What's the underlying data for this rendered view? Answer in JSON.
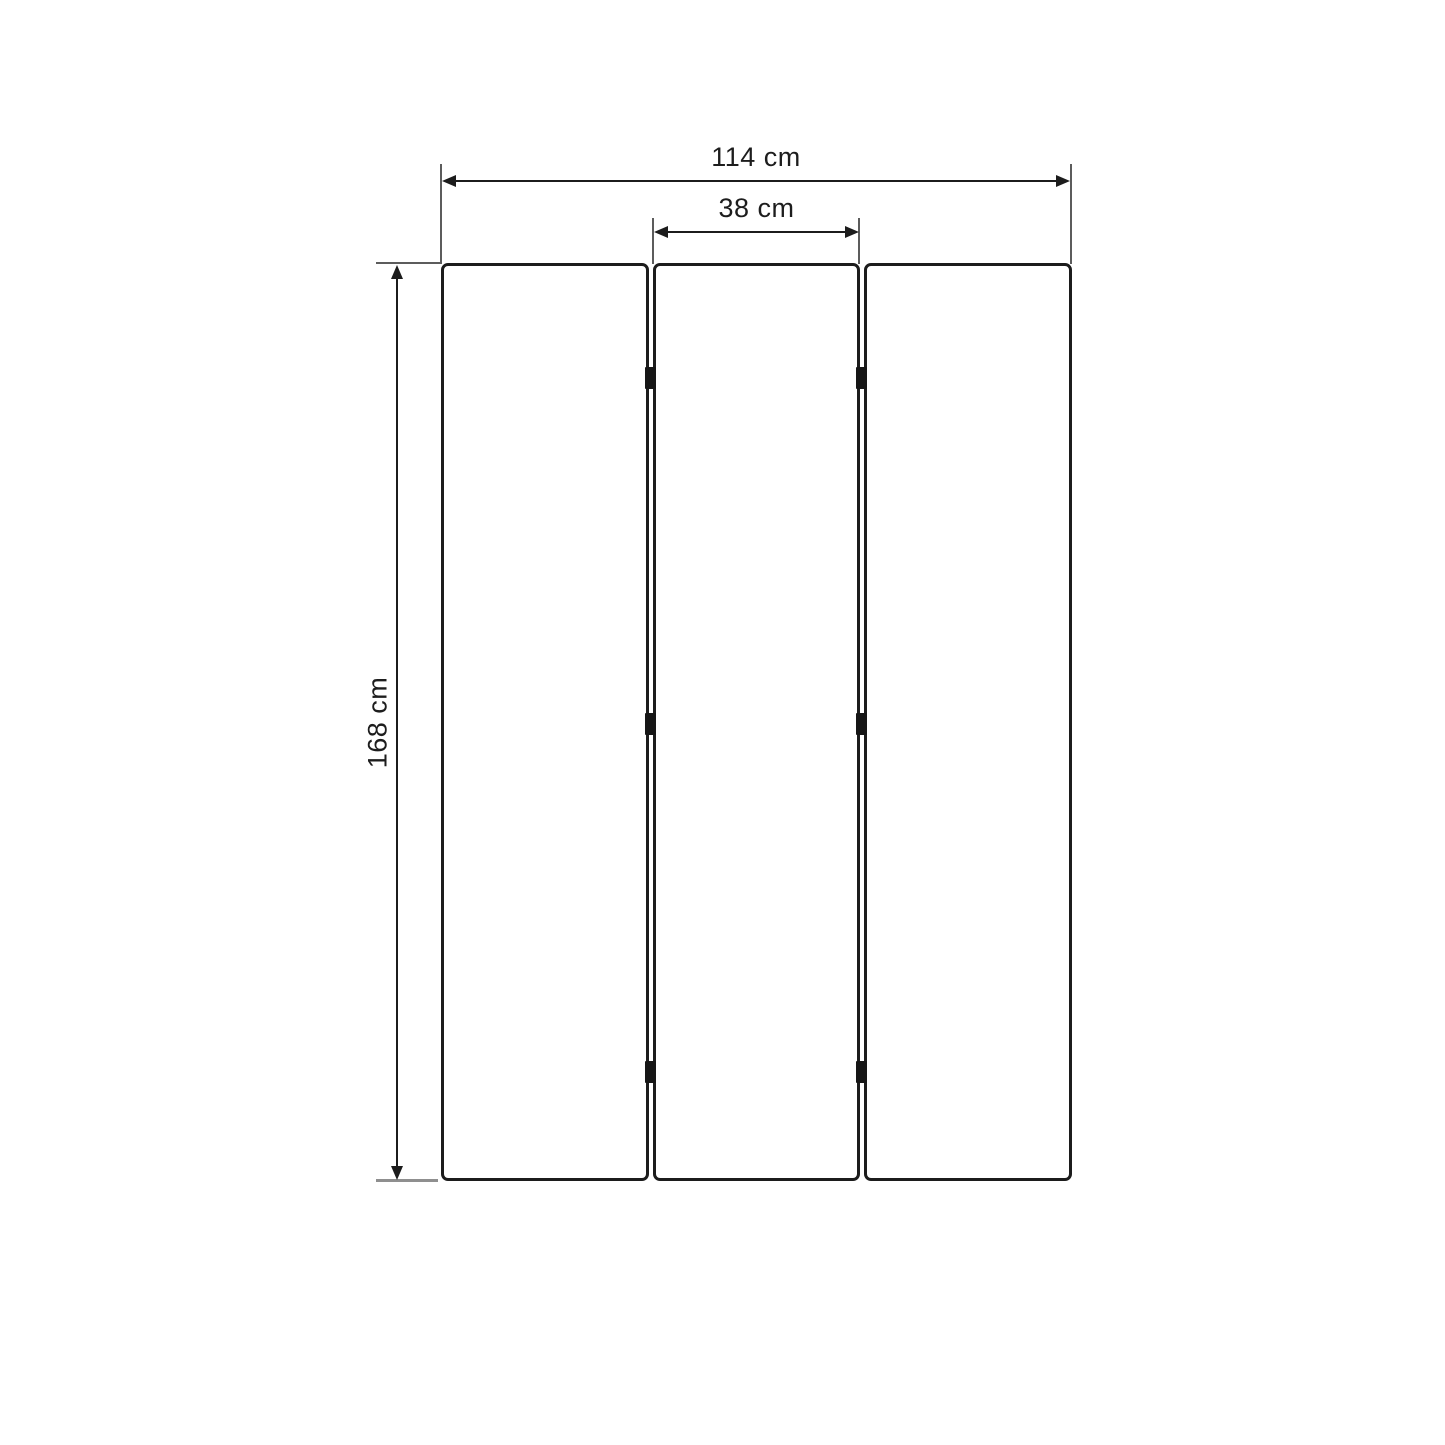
{
  "diagram": {
    "type": "dimension-diagram",
    "panel_count": 3,
    "dimensions": {
      "total_width_label": "114 cm",
      "panel_width_label": "38 cm",
      "height_label": "168 cm"
    },
    "colors": {
      "background": "#ffffff",
      "panel_border": "#1c1c1c",
      "panel_fill": "#ffffff",
      "hinge": "#161616",
      "dimension_line": "#1c1c1c",
      "extension_line": "#5c5c5c",
      "ground_line": "#8f8f8f",
      "label_text": "#1d1d1d"
    }
  }
}
